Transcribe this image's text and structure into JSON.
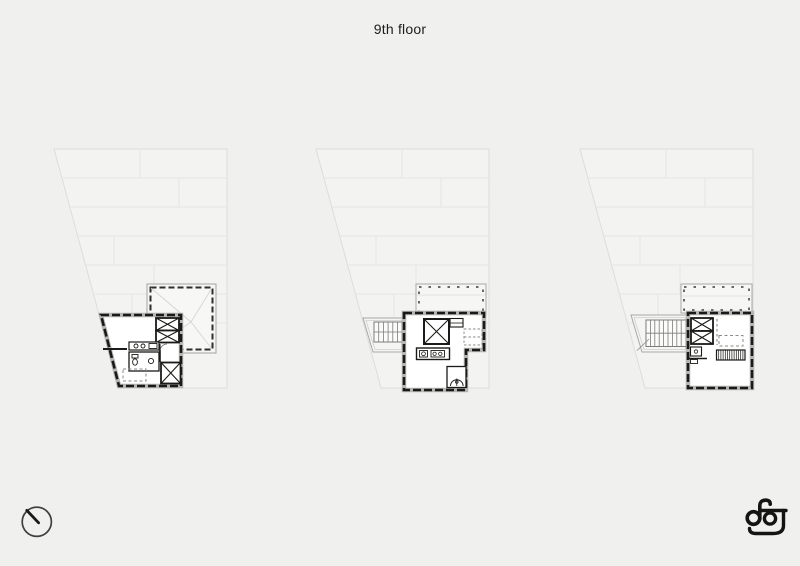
{
  "page": {
    "title": "9th floor"
  },
  "colors": {
    "background": "#f0f0ef",
    "ink": "#1a1a18",
    "wall_band": "#b5b5b3",
    "paper_fill": "#f6f6f5",
    "faint_line": "#e6e6e4"
  },
  "plans": [
    {
      "id": "variant-1",
      "elements": [
        "building-footprint",
        "hip-roof-outline",
        "apartment-unit",
        "elevator-shaft",
        "kitchen-counter",
        "bathroom",
        "dashed-table",
        "stair-shaft"
      ]
    },
    {
      "id": "variant-2",
      "elements": [
        "building-footprint",
        "roof-terrace",
        "stair-terrace",
        "apartment-unit",
        "elevator-shaft",
        "kitchen-island",
        "bathroom",
        "dashed-desk"
      ]
    },
    {
      "id": "variant-3",
      "elements": [
        "building-footprint",
        "roof-terrace",
        "stair-terrace",
        "apartment-unit",
        "elevator-shaft",
        "bathroom",
        "dashed-table",
        "hatched-bench"
      ]
    }
  ],
  "footer": {
    "north_icon": "north-indicator-icon",
    "logo_monogram": "ag"
  }
}
